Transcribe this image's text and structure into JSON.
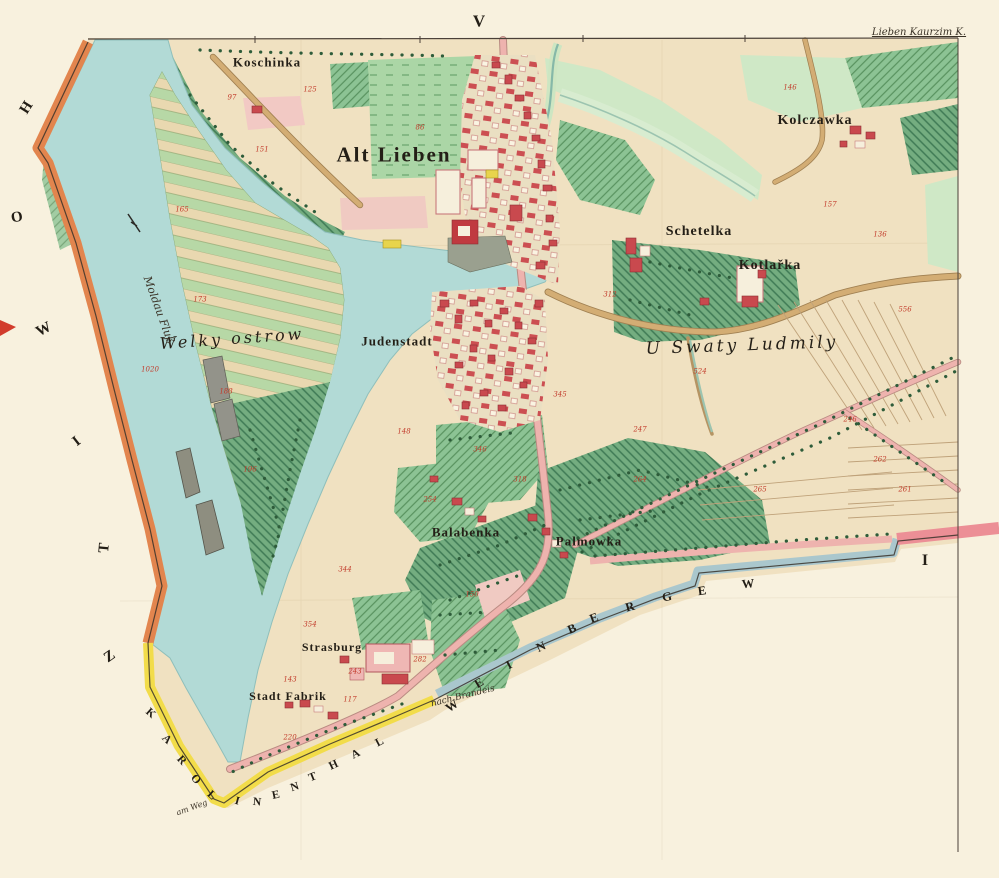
{
  "map": {
    "title": "Alt Lieben cadastral sheet",
    "colors": {
      "paper": "#f8f1de",
      "land": "#f0e1c1",
      "water": "#b2dad6",
      "green_dark": "#74ad80",
      "green_light": "#cfe8c6",
      "meadow": "#abd6a6",
      "road_pink": "#eeb3ae",
      "road_tan": "#d3ad74",
      "building_red": "#c9494e",
      "border_orange": "#e2854e",
      "border_yellow": "#f2dc4a",
      "border_blue": "#aac7cd",
      "border_pink": "#ec8f96",
      "number_red": "#c23b2b"
    },
    "labels": [
      {
        "id": "sheet-v",
        "t": "V",
        "x": 479,
        "y": 21,
        "s": 17,
        "c": "b"
      },
      {
        "id": "sheet-i",
        "t": "I",
        "x": 925,
        "y": 561,
        "s": 16,
        "c": "b"
      },
      {
        "id": "corner-note",
        "t": "Lieben Kaurzim K.",
        "x": 919,
        "y": 33,
        "s": 10,
        "c": "c u"
      },
      {
        "id": "koschinka",
        "t": "Koschinka",
        "x": 267,
        "y": 62,
        "s": 13,
        "ls": 1,
        "c": "b"
      },
      {
        "id": "alt-lieben",
        "t": "Alt Lieben",
        "x": 394,
        "y": 155,
        "s": 21,
        "ls": 2,
        "c": "b"
      },
      {
        "id": "kolczawka",
        "t": "Kolczawka",
        "x": 815,
        "y": 121,
        "s": 14,
        "ls": 1,
        "c": "b"
      },
      {
        "id": "schetelka",
        "t": "Schetelka",
        "x": 699,
        "y": 232,
        "s": 14,
        "ls": 1,
        "c": "b"
      },
      {
        "id": "kotlarka",
        "t": "Kotlařka",
        "x": 770,
        "y": 266,
        "s": 14,
        "ls": 1,
        "c": "b"
      },
      {
        "id": "welky-ostrow",
        "t": "Welky ostrow",
        "x": 232,
        "y": 339,
        "s": 16,
        "r": -4,
        "c": "i"
      },
      {
        "id": "moldau-fluss",
        "t": "Moldau Fluß",
        "x": 159,
        "y": 310,
        "s": 11,
        "r": 70,
        "c": "c"
      },
      {
        "id": "judenstadt",
        "t": "Judenstadt",
        "x": 397,
        "y": 341,
        "s": 13,
        "ls": 1,
        "c": "b"
      },
      {
        "id": "u-swaty-ludmily",
        "t": "U Swaty Ludmily",
        "x": 742,
        "y": 346,
        "s": 17,
        "r": -2,
        "c": "i"
      },
      {
        "id": "balabenka",
        "t": "Balabenka",
        "x": 466,
        "y": 532,
        "s": 13,
        "ls": 1,
        "c": "b"
      },
      {
        "id": "palmowka",
        "t": "Palmowka",
        "x": 589,
        "y": 541,
        "s": 13,
        "ls": 1,
        "c": "b"
      },
      {
        "id": "strasburg",
        "t": "Strasburg",
        "x": 332,
        "y": 647,
        "s": 12,
        "ls": 1,
        "c": "b"
      },
      {
        "id": "stadt-fabrik",
        "t": "Stadt Fabrik",
        "x": 288,
        "y": 696,
        "s": 12,
        "ls": 1,
        "c": "b"
      },
      {
        "id": "nach-brandeis",
        "t": "nach Brandeis",
        "x": 463,
        "y": 697,
        "s": 9,
        "r": -14,
        "c": "c"
      },
      {
        "id": "am-weg",
        "t": "am Weg",
        "x": 192,
        "y": 808,
        "s": 8,
        "r": -20,
        "c": "c"
      }
    ],
    "neighbor_letters_left": [
      {
        "t": "H",
        "x": 27,
        "y": 108,
        "r": -58
      },
      {
        "t": "O",
        "x": 17,
        "y": 218,
        "r": -10
      },
      {
        "t": "W",
        "x": 44,
        "y": 330,
        "r": -28
      },
      {
        "t": "I",
        "x": 77,
        "y": 442,
        "r": -38
      },
      {
        "t": "T",
        "x": 105,
        "y": 548,
        "r": -85
      },
      {
        "t": "Z",
        "x": 110,
        "y": 657,
        "r": -35
      }
    ],
    "karolinenthal": {
      "word": "KAROLINENTHAL",
      "letters": [
        {
          "t": "K",
          "x": 150,
          "y": 714,
          "r": 42
        },
        {
          "t": "A",
          "x": 166,
          "y": 740,
          "r": 45
        },
        {
          "t": "R",
          "x": 181,
          "y": 761,
          "r": 48
        },
        {
          "t": "O",
          "x": 195,
          "y": 780,
          "r": 50
        },
        {
          "t": "L",
          "x": 211,
          "y": 796,
          "r": 42
        },
        {
          "t": "I",
          "x": 237,
          "y": 802,
          "r": 15
        },
        {
          "t": "N",
          "x": 257,
          "y": 803,
          "r": 5
        },
        {
          "t": "E",
          "x": 276,
          "y": 796,
          "r": -12
        },
        {
          "t": "N",
          "x": 295,
          "y": 788,
          "r": -18
        },
        {
          "t": "T",
          "x": 313,
          "y": 778,
          "r": -22
        },
        {
          "t": "H",
          "x": 334,
          "y": 766,
          "r": -25
        },
        {
          "t": "A",
          "x": 356,
          "y": 755,
          "r": -27
        },
        {
          "t": "L",
          "x": 380,
          "y": 743,
          "r": -28
        }
      ]
    },
    "weinberge": {
      "word": "WEINBERGE W",
      "letters": [
        {
          "t": "W",
          "x": 452,
          "y": 706,
          "r": -35
        },
        {
          "t": "E",
          "x": 479,
          "y": 683,
          "r": -32
        },
        {
          "t": "I",
          "x": 509,
          "y": 665,
          "r": -28
        },
        {
          "t": "N",
          "x": 541,
          "y": 647,
          "r": -25
        },
        {
          "t": "B",
          "x": 572,
          "y": 629,
          "r": -22
        },
        {
          "t": "E",
          "x": 594,
          "y": 618,
          "r": -20
        },
        {
          "t": "R",
          "x": 630,
          "y": 607,
          "r": -15
        },
        {
          "t": "G",
          "x": 667,
          "y": 597,
          "r": -10
        },
        {
          "t": "E",
          "x": 702,
          "y": 591,
          "r": -8
        },
        {
          "t": "W",
          "x": 748,
          "y": 584,
          "r": -5
        }
      ]
    },
    "parcel_numbers": [
      {
        "t": "165",
        "x": 182,
        "y": 210
      },
      {
        "t": "173",
        "x": 200,
        "y": 300
      },
      {
        "t": "188",
        "x": 226,
        "y": 392
      },
      {
        "t": "196",
        "x": 250,
        "y": 470
      },
      {
        "t": "1020",
        "x": 150,
        "y": 370
      },
      {
        "t": "151",
        "x": 262,
        "y": 150
      },
      {
        "t": "86",
        "x": 420,
        "y": 128
      },
      {
        "t": "125",
        "x": 310,
        "y": 90
      },
      {
        "t": "97",
        "x": 232,
        "y": 98
      },
      {
        "t": "146",
        "x": 790,
        "y": 88
      },
      {
        "t": "157",
        "x": 830,
        "y": 205
      },
      {
        "t": "136",
        "x": 880,
        "y": 235
      },
      {
        "t": "556",
        "x": 905,
        "y": 310
      },
      {
        "t": "312",
        "x": 610,
        "y": 295
      },
      {
        "t": "524",
        "x": 700,
        "y": 372
      },
      {
        "t": "345",
        "x": 560,
        "y": 395
      },
      {
        "t": "346",
        "x": 480,
        "y": 450
      },
      {
        "t": "254",
        "x": 430,
        "y": 500
      },
      {
        "t": "318",
        "x": 520,
        "y": 480
      },
      {
        "t": "264",
        "x": 640,
        "y": 480
      },
      {
        "t": "265",
        "x": 760,
        "y": 490
      },
      {
        "t": "262",
        "x": 880,
        "y": 460
      },
      {
        "t": "261",
        "x": 905,
        "y": 490
      },
      {
        "t": "247",
        "x": 640,
        "y": 430
      },
      {
        "t": "246",
        "x": 850,
        "y": 420
      },
      {
        "t": "344",
        "x": 345,
        "y": 570
      },
      {
        "t": "354",
        "x": 310,
        "y": 625
      },
      {
        "t": "143",
        "x": 290,
        "y": 680
      },
      {
        "t": "117",
        "x": 350,
        "y": 700
      },
      {
        "t": "282",
        "x": 420,
        "y": 660
      },
      {
        "t": "220",
        "x": 290,
        "y": 738
      },
      {
        "t": "243",
        "x": 355,
        "y": 672
      },
      {
        "t": "148",
        "x": 404,
        "y": 432
      },
      {
        "t": "150",
        "x": 472,
        "y": 595
      }
    ]
  }
}
